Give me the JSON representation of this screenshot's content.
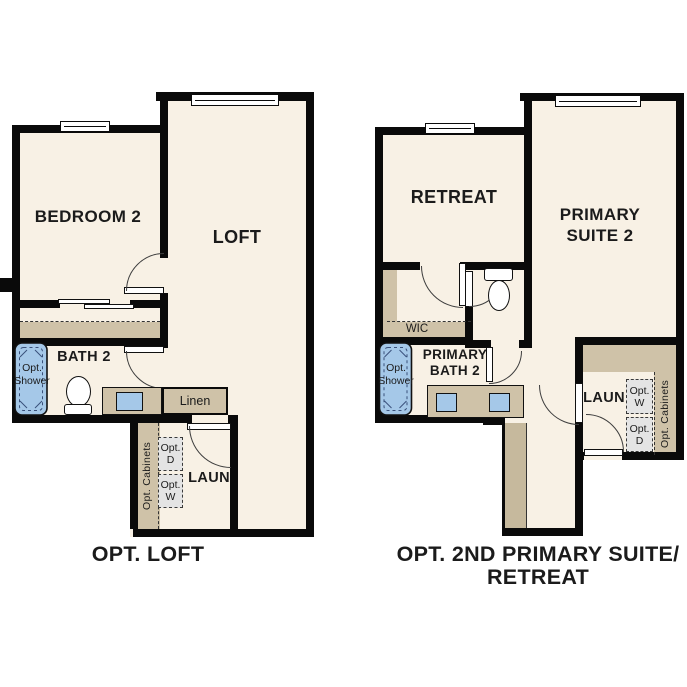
{
  "meta": {
    "type": "floorplan-options-diagram"
  },
  "colors": {
    "background": "#ffffff",
    "wall": "#0a0a0a",
    "floor": "#f8f1e5",
    "cabinet_tan": "#cfc2a8",
    "cabinet_tan_dark": "#c6b99d",
    "fixture_blue": "#a5c8e8",
    "opt_box_gray": "#e4e4e4",
    "text": "#1b1b1b"
  },
  "plan1": {
    "caption": "OPT. LOFT",
    "bedroom2": "BEDROOM 2",
    "loft": "LOFT",
    "bath2": "BATH 2",
    "laun": "LAUN",
    "linen": "Linen",
    "opt_cabinets": "Opt. Cabinets",
    "opt_shower1": "Opt.",
    "opt_shower2": "Shower",
    "opt_d1": "Opt.",
    "opt_d2": "D",
    "opt_w1": "Opt.",
    "opt_w2": "W"
  },
  "plan2": {
    "caption1": "OPT. 2ND PRIMARY SUITE/",
    "caption2": "RETREAT",
    "retreat": "RETREAT",
    "suite1": "PRIMARY",
    "suite2": "SUITE 2",
    "wic": "WIC",
    "bath1": "PRIMARY",
    "bath2": "BATH 2",
    "laun": "LAUN",
    "opt_cabinets": "Opt. Cabinets",
    "opt_shower1": "Opt.",
    "opt_shower2": "Shower",
    "opt_w1": "Opt.",
    "opt_w2": "W",
    "opt_d1": "Opt.",
    "opt_d2": "D"
  }
}
